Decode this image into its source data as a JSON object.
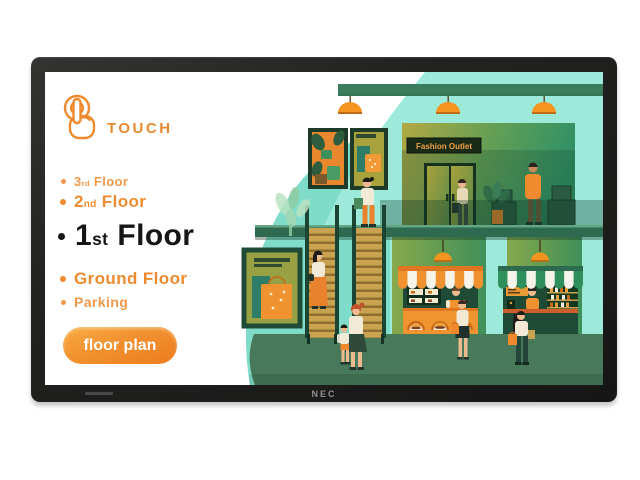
{
  "device": {
    "brand_logo": "NEC"
  },
  "panel": {
    "touch_label": "TOUCH",
    "floors": [
      {
        "id": "3rd-floor",
        "num": "3",
        "ord": "rd",
        "rest": "Floor",
        "selected": false
      },
      {
        "id": "2nd-floor",
        "num": "2",
        "ord": "nd",
        "rest": "Floor",
        "selected": false
      },
      {
        "id": "1st-floor",
        "num": "1",
        "ord": "st",
        "rest": "Floor",
        "selected": true
      },
      {
        "id": "ground-floor",
        "full": "Ground Floor",
        "selected": false
      },
      {
        "id": "parking",
        "full": "Parking",
        "selected": false
      }
    ],
    "floor_plan_button": "floor plan"
  },
  "illustration": {
    "store_sign": "Fashion Outlet"
  },
  "colors": {
    "accent_orange": "#ee8a2f",
    "button_gradient_top": "#f9ac42",
    "button_gradient_bottom": "#ec7c1e",
    "mint": "#9eeada",
    "teal_blob": "#7edcc9",
    "dark_green": "#2d6a50",
    "floor_green": "#47795a",
    "awning_orange": "#f0922f",
    "awning_green": "#2f8f5d",
    "bezel_black": "#1c1c1c"
  }
}
